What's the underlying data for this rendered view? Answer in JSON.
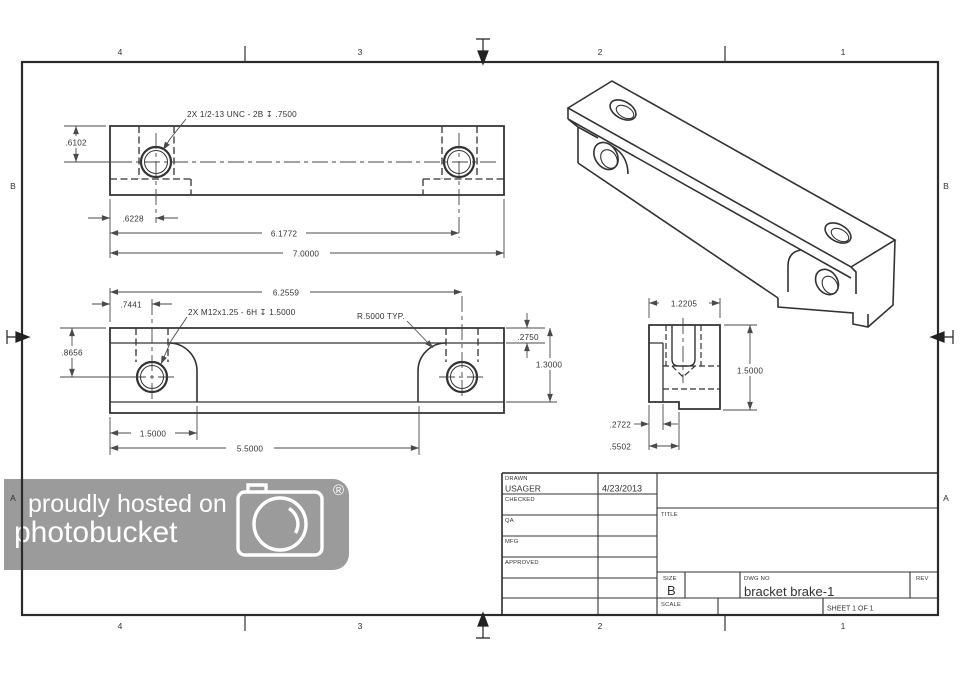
{
  "sheet": {
    "zones": {
      "top": [
        "4",
        "3",
        "2",
        "1"
      ],
      "bottom": [
        "4",
        "3",
        "2",
        "1"
      ],
      "left": [
        "B",
        "A"
      ],
      "right": [
        "B",
        "A"
      ]
    }
  },
  "top_view": {
    "callout": "2X 1/2-13 UNC - 2B ↧ .7500",
    "dim_hole_from_top": ".6102",
    "dim_hole_from_left": ".6228",
    "dim_hole_span": "6.1772",
    "dim_overall": "7.0000"
  },
  "front_view": {
    "callout": "2X M12x1.25 - 6H ↧ 1.5000",
    "radius_note": "R.5000 TYP.",
    "dim_span_to_hole": "6.2559",
    "dim_hole_from_left": ".7441",
    "dim_hole_from_top": ".8656",
    "dim_top_strip": ".2750",
    "dim_height": "1.3000",
    "dim_boss_width": "1.5000",
    "dim_boss_span": "5.5000"
  },
  "side_view": {
    "dim_width": "1.2205",
    "dim_height": "1.5000",
    "dim_web": ".2722",
    "dim_step": ".5502"
  },
  "title_block": {
    "rows": [
      {
        "label": "DRAWN",
        "name": "USAGER",
        "date": "4/23/2013"
      },
      {
        "label": "CHECKED",
        "name": "",
        "date": ""
      },
      {
        "label": "QA",
        "name": "",
        "date": ""
      },
      {
        "label": "MFG",
        "name": "",
        "date": ""
      },
      {
        "label": "APPROVED",
        "name": "",
        "date": ""
      }
    ],
    "title_label": "TITLE",
    "size_label": "SIZE",
    "size_value": "B",
    "dwg_label": "DWG NO",
    "dwg_value": "bracket brake-1",
    "rev_label": "REV",
    "scale_label": "SCALE",
    "sheet_note": "SHEET 1  OF 1"
  },
  "watermark": {
    "line1": "proudly hosted on",
    "line2": "photobucket",
    "registered": "®",
    "background": "#9b9b9b",
    "foreground": "#ffffff"
  },
  "colors": {
    "line": "#333333",
    "dim": "#4a4a4a",
    "background": "#ffffff"
  }
}
